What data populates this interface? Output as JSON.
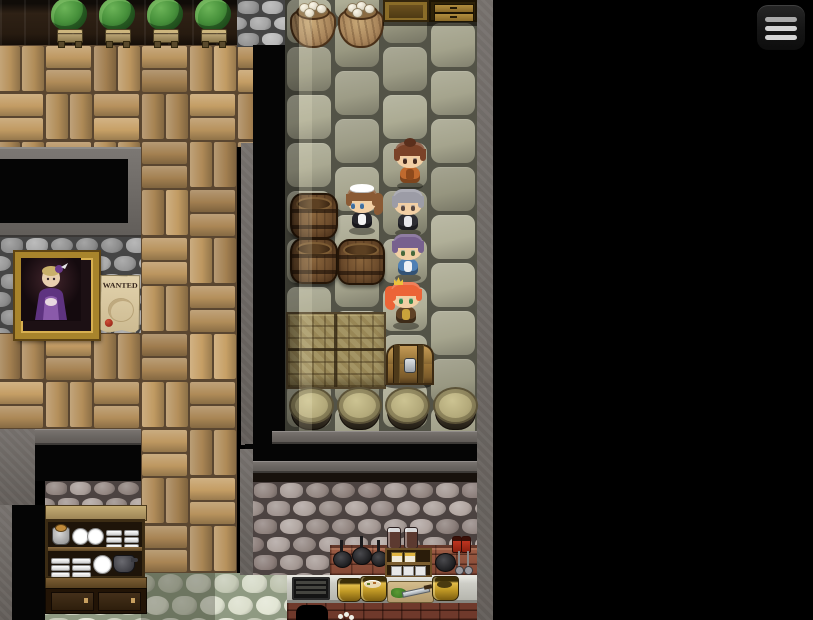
{
  "scene": {
    "description": "top-down RPG tavern interior with storeroom corridor and kitchen",
    "poster": {
      "text": "WANTED",
      "paper_color": "#e0d0aa",
      "seal_color": "#a02818"
    },
    "portrait": {
      "subject": "noblewoman in purple dress",
      "frame_color": "#c89a3a",
      "dress_color": "#7a4a9a",
      "hair_color": "#c9b06a"
    },
    "npcs": [
      {
        "id": "villager-orange-dress",
        "headgear": "bun",
        "hair": "#7a4228",
        "hair2": "#5a2f1c",
        "skin": "#f2cfa4",
        "eyes": "#432a1e",
        "outfit": "#c06a2e",
        "outfit2": "#8e4a1c"
      },
      {
        "id": "maid",
        "headgear": "maid-band",
        "hair": "#8a5a34",
        "hair2": "#6d4527",
        "skin": "#f2cfa4",
        "eyes": "#3f6e9e",
        "outfit": "#26262c",
        "outfit2": "#f4f4f4"
      },
      {
        "id": "villager-gray-hair",
        "headgear": "none",
        "hair": "#9c9ca6",
        "hair2": "#74747e",
        "skin": "#f2cfa4",
        "eyes": "#584740",
        "outfit": "#2d2d33",
        "outfit2": "#e6e6ea"
      },
      {
        "id": "villager-blue-dress",
        "headgear": "none",
        "hair": "#77618e",
        "hair2": "#594671",
        "skin": "#f2cfa4",
        "eyes": "#49683b",
        "outfit": "#4f80b4",
        "outfit2": "#eef1f4"
      },
      {
        "id": "adventurer-red-hair",
        "headgear": "crown",
        "hair": "#ec6437",
        "hair2": "#c44624",
        "skin": "#f2cfa4",
        "eyes": "#37884b",
        "outfit": "#5f4226",
        "outfit2": "#c9a23b"
      }
    ],
    "props": [
      {
        "name": "potted-plant",
        "count": 4
      },
      {
        "name": "sack-of-eggs",
        "count": 2
      },
      {
        "name": "wooden-barrel",
        "count": 3
      },
      {
        "name": "covered-barrel",
        "count": 4
      },
      {
        "name": "storage-crates",
        "count": 1
      },
      {
        "name": "treasure-chest",
        "count": 1
      },
      {
        "name": "dish-cabinet",
        "count": 1
      },
      {
        "name": "kitchen-counter-with-pots",
        "count": 1
      },
      {
        "name": "framed-portrait",
        "count": 1
      },
      {
        "name": "wanted-poster",
        "count": 1
      }
    ]
  },
  "hud": {
    "menu_button": {
      "icon": "hamburger-menu-icon",
      "bg": "#1b1b1b",
      "bar": "#d4d4d4"
    }
  },
  "palette": {
    "floor_brick_light": "#c9a267",
    "floor_brick_dark": "#8f6f46",
    "floor_brick_grout": "#5e4a32",
    "corridor_stone_light": "#b2b19a",
    "corridor_stone_dark": "#878672",
    "corridor_grout": "#55554a",
    "wall_gray_light": "#b2b2b2",
    "wall_gray_dark": "#787878",
    "wall_gray_grout": "#474747",
    "wall_pink_light": "#b3a8a3",
    "wall_pink_dark": "#7d6f6b",
    "wall_pink_grout": "#4e4543",
    "floor_pale_light": "#e3e6d6",
    "floor_pale_dark": "#b9bda9",
    "floor_pale_grout": "#97a089",
    "backsplash_brick": "#93503b",
    "counter_top": "#cdcdc6",
    "gold": "#c29a26"
  }
}
